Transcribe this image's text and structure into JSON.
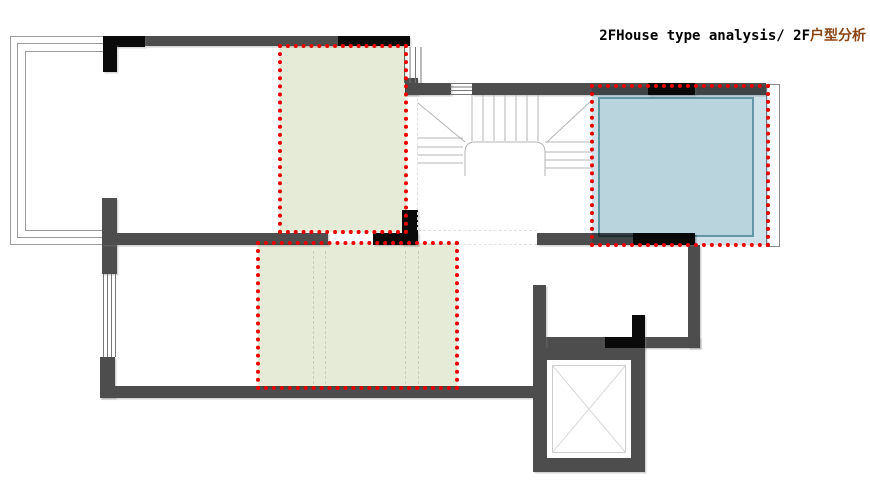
{
  "title": {
    "main": "2FHouse type analysis/ 2F",
    "highlight": "户型分析"
  },
  "colors": {
    "wall": "#4d4d4d",
    "column": "#0a0a0a",
    "green-fill": "#e5ebd7",
    "blue-fill": "#cfe2e9",
    "blue-inner": "#b9d4dc",
    "blue-inner-border": "#6495a5",
    "red-annotation": "#ea0000",
    "line": "#9a9a9a",
    "stair-line": "#b5b5b5",
    "dash-line": "#e0e0e0",
    "title-highlight": "#8b4513"
  },
  "floor_plan": {
    "floor": "2F",
    "highlight_zones": [
      {
        "id": "zone-upper-green",
        "style": "green dotted",
        "position": "upper middle"
      },
      {
        "id": "zone-lower-green",
        "style": "green dotted",
        "position": "lower middle"
      },
      {
        "id": "zone-blue",
        "style": "blue dotted",
        "position": "upper right"
      }
    ],
    "features": [
      "terrace-railing",
      "staircase",
      "elevator-shaft",
      "windows",
      "walls"
    ]
  }
}
